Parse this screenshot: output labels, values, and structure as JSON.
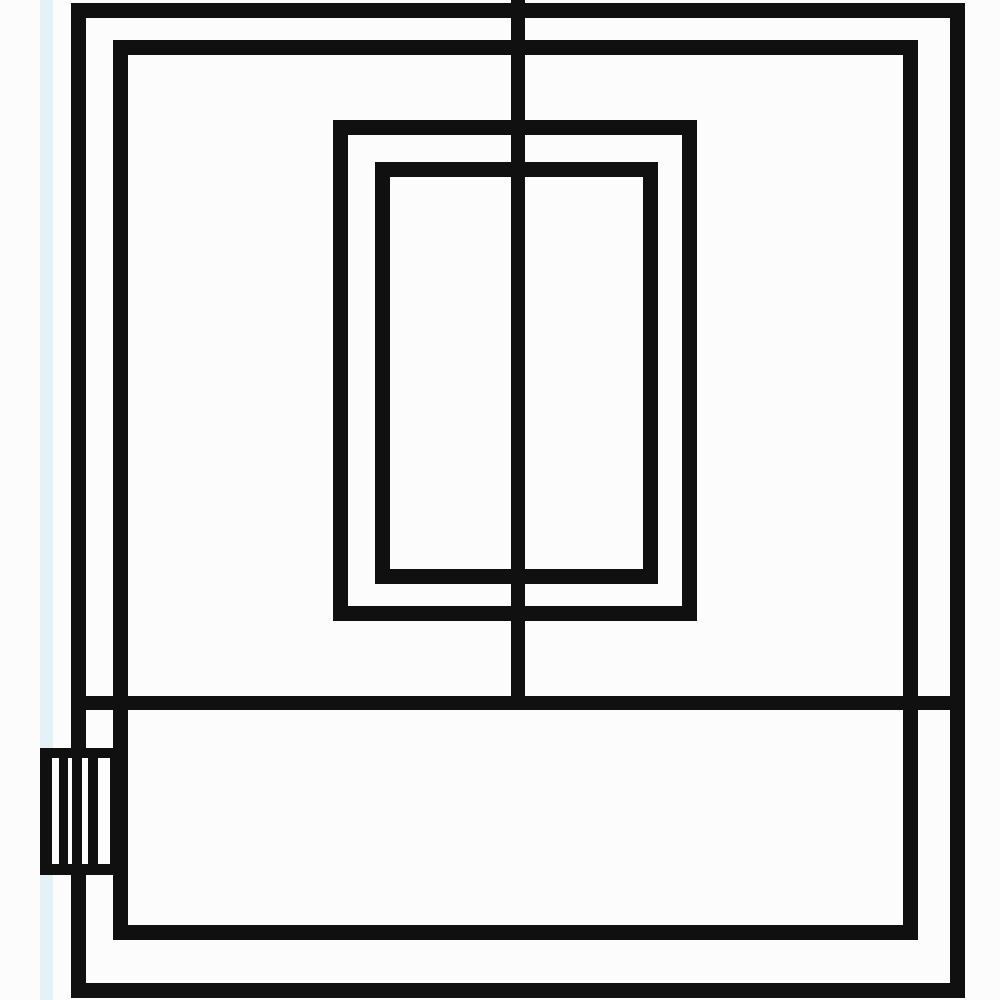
{
  "meta": {
    "description": "Black-and-white schematic line drawing of an appliance front: outer casing, inner casing, centered double-rectangle door window, full-height center divider line, horizontal separator forming a bottom drawer band, and a striped connector block protruding on the lower-left edge",
    "text_content": "none"
  },
  "colors": {
    "background": "#fcfcfc",
    "line": "#101010",
    "paper_strip": "#e4f2f8",
    "panel_fill": "#fdfdfd"
  },
  "diagram": {
    "width": 1000,
    "height": 1000,
    "shapes": [
      {
        "name": "scan-edge-strip",
        "kind": "fill",
        "x": 40,
        "y": 0,
        "w": 13,
        "h": 1000,
        "color": "paper_strip"
      },
      {
        "name": "outer-casing-outline",
        "kind": "outline",
        "x": 71,
        "y": 3,
        "w": 894,
        "h": 995,
        "stroke": 15
      },
      {
        "name": "inner-casing-outline",
        "kind": "outline",
        "x": 113,
        "y": 40,
        "w": 805,
        "h": 900,
        "stroke": 15
      },
      {
        "name": "door-window-outer-outline",
        "kind": "outline",
        "x": 333,
        "y": 120,
        "w": 364,
        "h": 501,
        "stroke": 15
      },
      {
        "name": "door-window-inner-outline",
        "kind": "outline",
        "x": 375,
        "y": 162,
        "w": 283,
        "h": 422,
        "stroke": 15
      },
      {
        "name": "center-divider-line",
        "kind": "fill",
        "x": 511,
        "y": 0,
        "w": 14,
        "h": 710,
        "color": "line"
      },
      {
        "name": "separator-line",
        "kind": "fill",
        "x": 71,
        "y": 696,
        "w": 894,
        "h": 14,
        "color": "line"
      },
      {
        "name": "connector-backing",
        "kind": "fill",
        "x": 40,
        "y": 748,
        "w": 88,
        "h": 127,
        "color": "panel_fill"
      },
      {
        "name": "connector-top-edge",
        "kind": "fill",
        "x": 40,
        "y": 748,
        "w": 88,
        "h": 10,
        "color": "line"
      },
      {
        "name": "connector-bottom-edge",
        "kind": "fill",
        "x": 40,
        "y": 864,
        "w": 88,
        "h": 11,
        "color": "line"
      },
      {
        "name": "connector-left-edge",
        "kind": "fill",
        "x": 40,
        "y": 748,
        "w": 12,
        "h": 127,
        "color": "line"
      },
      {
        "name": "connector-pin-1",
        "kind": "fill",
        "x": 59,
        "y": 748,
        "w": 9,
        "h": 127,
        "color": "line"
      },
      {
        "name": "connector-pin-2",
        "kind": "fill",
        "x": 72,
        "y": 748,
        "w": 10,
        "h": 127,
        "color": "line"
      },
      {
        "name": "connector-pin-3",
        "kind": "fill",
        "x": 88,
        "y": 748,
        "w": 10,
        "h": 127,
        "color": "line"
      },
      {
        "name": "connector-right-edge",
        "kind": "fill",
        "x": 110,
        "y": 748,
        "w": 18,
        "h": 127,
        "color": "line"
      }
    ]
  }
}
